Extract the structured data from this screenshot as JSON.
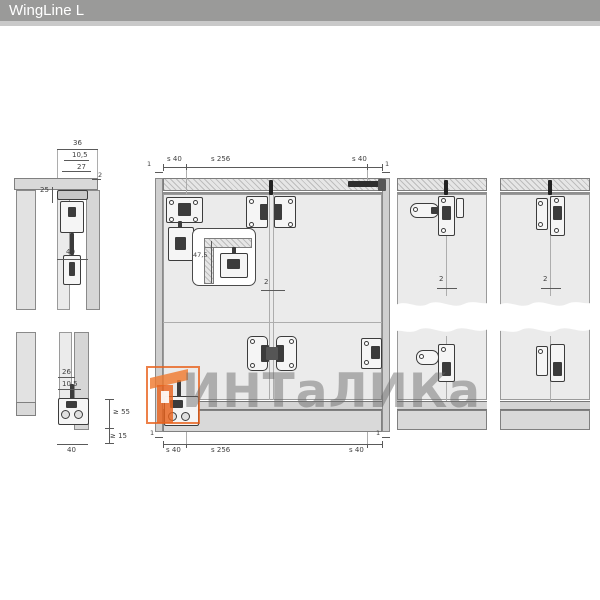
{
  "header": {
    "title": "WingLine L"
  },
  "colors": {
    "title_bar": "#9a9a99",
    "accent_orange": "#e8621c",
    "drawing_line": "#5a5a5a",
    "panel_fill": "#ebebeb"
  },
  "watermark": {
    "text": "ИНТаЛИКа"
  },
  "side_view": {
    "top_dims": {
      "total_width": "36",
      "inner_width": "10,5",
      "track_width": "27",
      "gap": "2",
      "track_height": "25",
      "fitting_depth": "40"
    },
    "bottom_dims": {
      "top_width": "26",
      "inner_width": "10,5",
      "min_clearance": "≥ 55",
      "min_floor": "≥ 15",
      "fitting_depth": "40"
    }
  },
  "front_view": {
    "dims": {
      "side_gap": "1",
      "edge_offset": "s 40",
      "hinge_spacing": "s 256"
    },
    "detail_inset": {
      "height": "47,5"
    },
    "door_gap": "2"
  },
  "panels": [
    {
      "door_gap": "2"
    },
    {
      "door_gap": "2"
    }
  ]
}
